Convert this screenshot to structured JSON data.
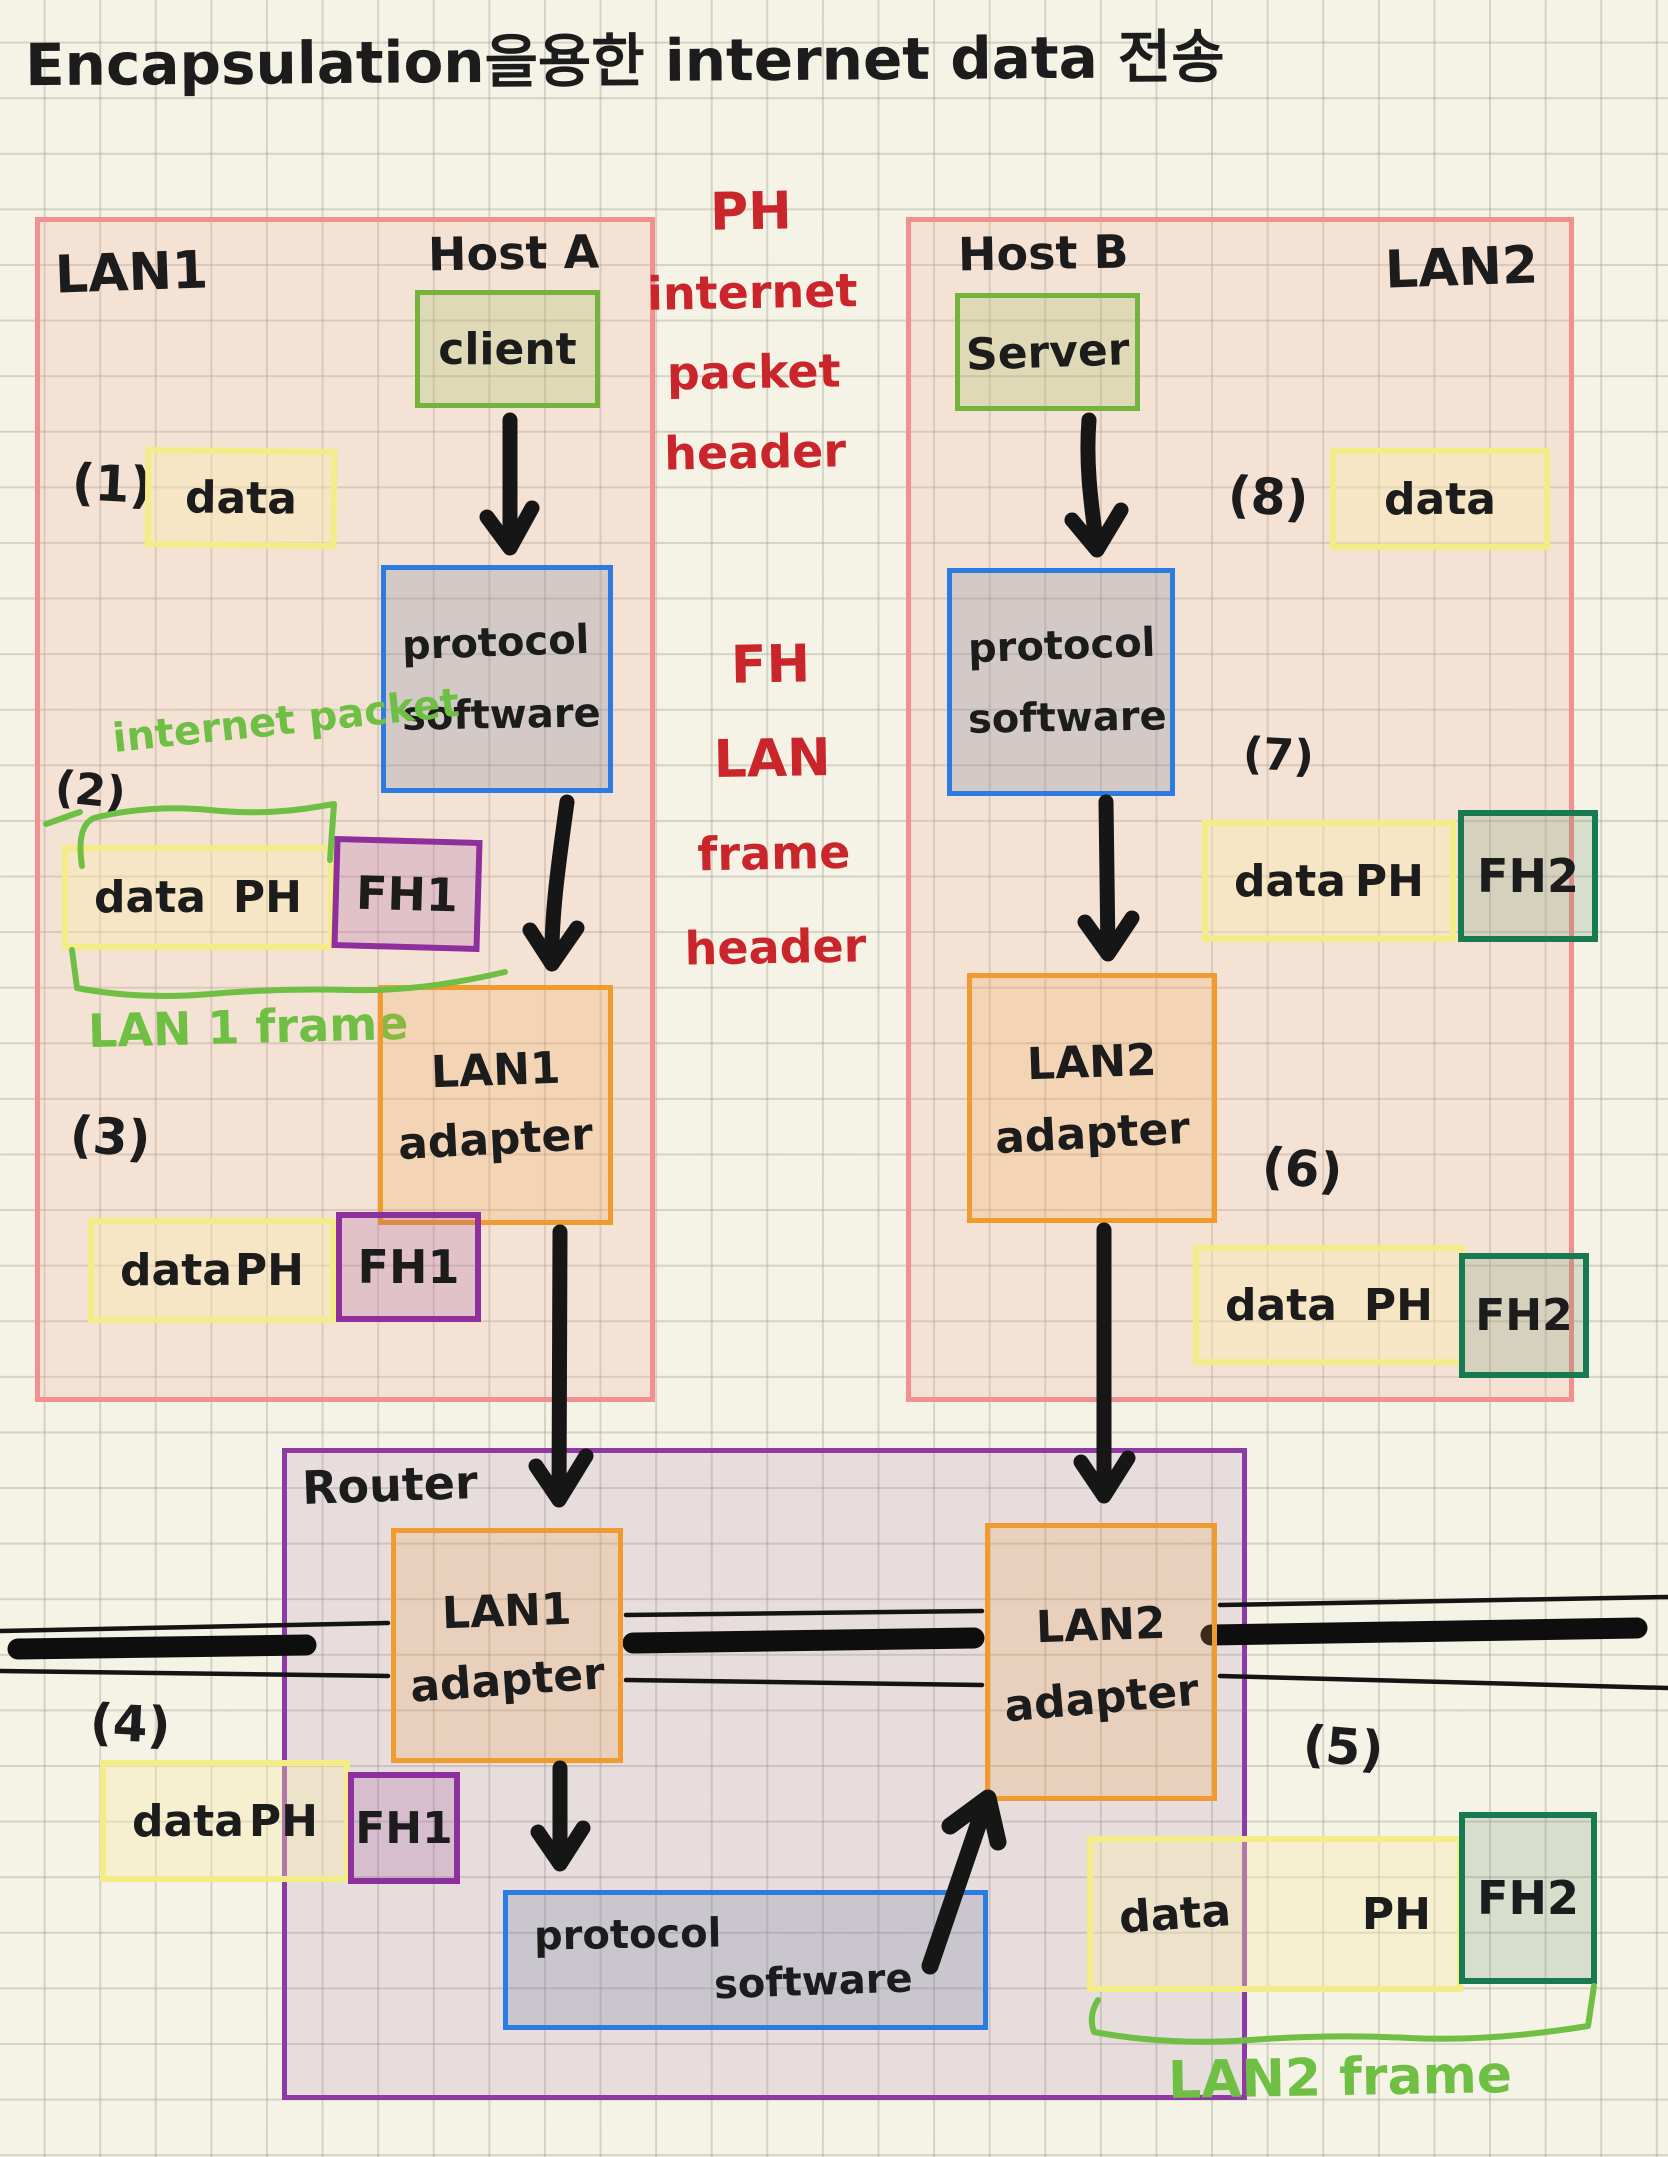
{
  "title": "Encapsulation을용한 internet data 전송",
  "notes": {
    "ph": {
      "l1": "PH",
      "l2": "internet",
      "l3": "packet",
      "l4": "header"
    },
    "fh": {
      "l1": "FH",
      "l2": "LAN",
      "l3": "frame",
      "l4": "header"
    }
  },
  "lan1": {
    "label": "LAN1",
    "host": "Host A",
    "node": "client",
    "psw1": "protocol",
    "psw2": "software",
    "ad1": "LAN1",
    "ad2": "adapter",
    "s1": "(1)",
    "s1_data": "data",
    "s2": "(2)",
    "s2_note": "internet packet",
    "s2_data": "data",
    "s2_ph": "PH",
    "s2_fh": "FH1",
    "s2_frame": "LAN 1 frame",
    "s3": "(3)",
    "s3_data": "data",
    "s3_ph": "PH",
    "s3_fh": "FH1"
  },
  "lan2": {
    "label": "LAN2",
    "host": "Host B",
    "node": "Server",
    "psw1": "protocol",
    "psw2": "software",
    "ad1": "LAN2",
    "ad2": "adapter",
    "s8": "(8)",
    "s8_data": "data",
    "s7": "(7)",
    "s7_data": "data",
    "s7_ph": "PH",
    "s7_fh": "FH2",
    "s6": "(6)",
    "s6_data": "data",
    "s6_ph": "PH",
    "s6_fh": "FH2"
  },
  "router": {
    "label": "Router",
    "ad1a": "LAN1",
    "ad1b": "adapter",
    "ad2a": "LAN2",
    "ad2b": "adapter",
    "psw1": "protocol",
    "psw2": "software",
    "s4": "(4)",
    "s4_data": "data",
    "s4_ph": "PH",
    "s4_fh": "FH1",
    "s5": "(5)",
    "s5_data": "data",
    "s5_ph": "PH",
    "s5_fh": "FH2",
    "s5_frame": "LAN2 frame"
  },
  "colors": {
    "ink": "#1c1c1c",
    "lan_border": "#f29090",
    "router_border": "#8d3aa5",
    "node_border": "#74b33e",
    "protocol_border": "#2b7be0",
    "adapter_border": "#f09b30",
    "data_border": "#f3ec87",
    "fh1_border": "#8e2f9e",
    "fh2_border": "#187a50",
    "green_note": "#6fbf44",
    "red_note": "#c9252b"
  }
}
